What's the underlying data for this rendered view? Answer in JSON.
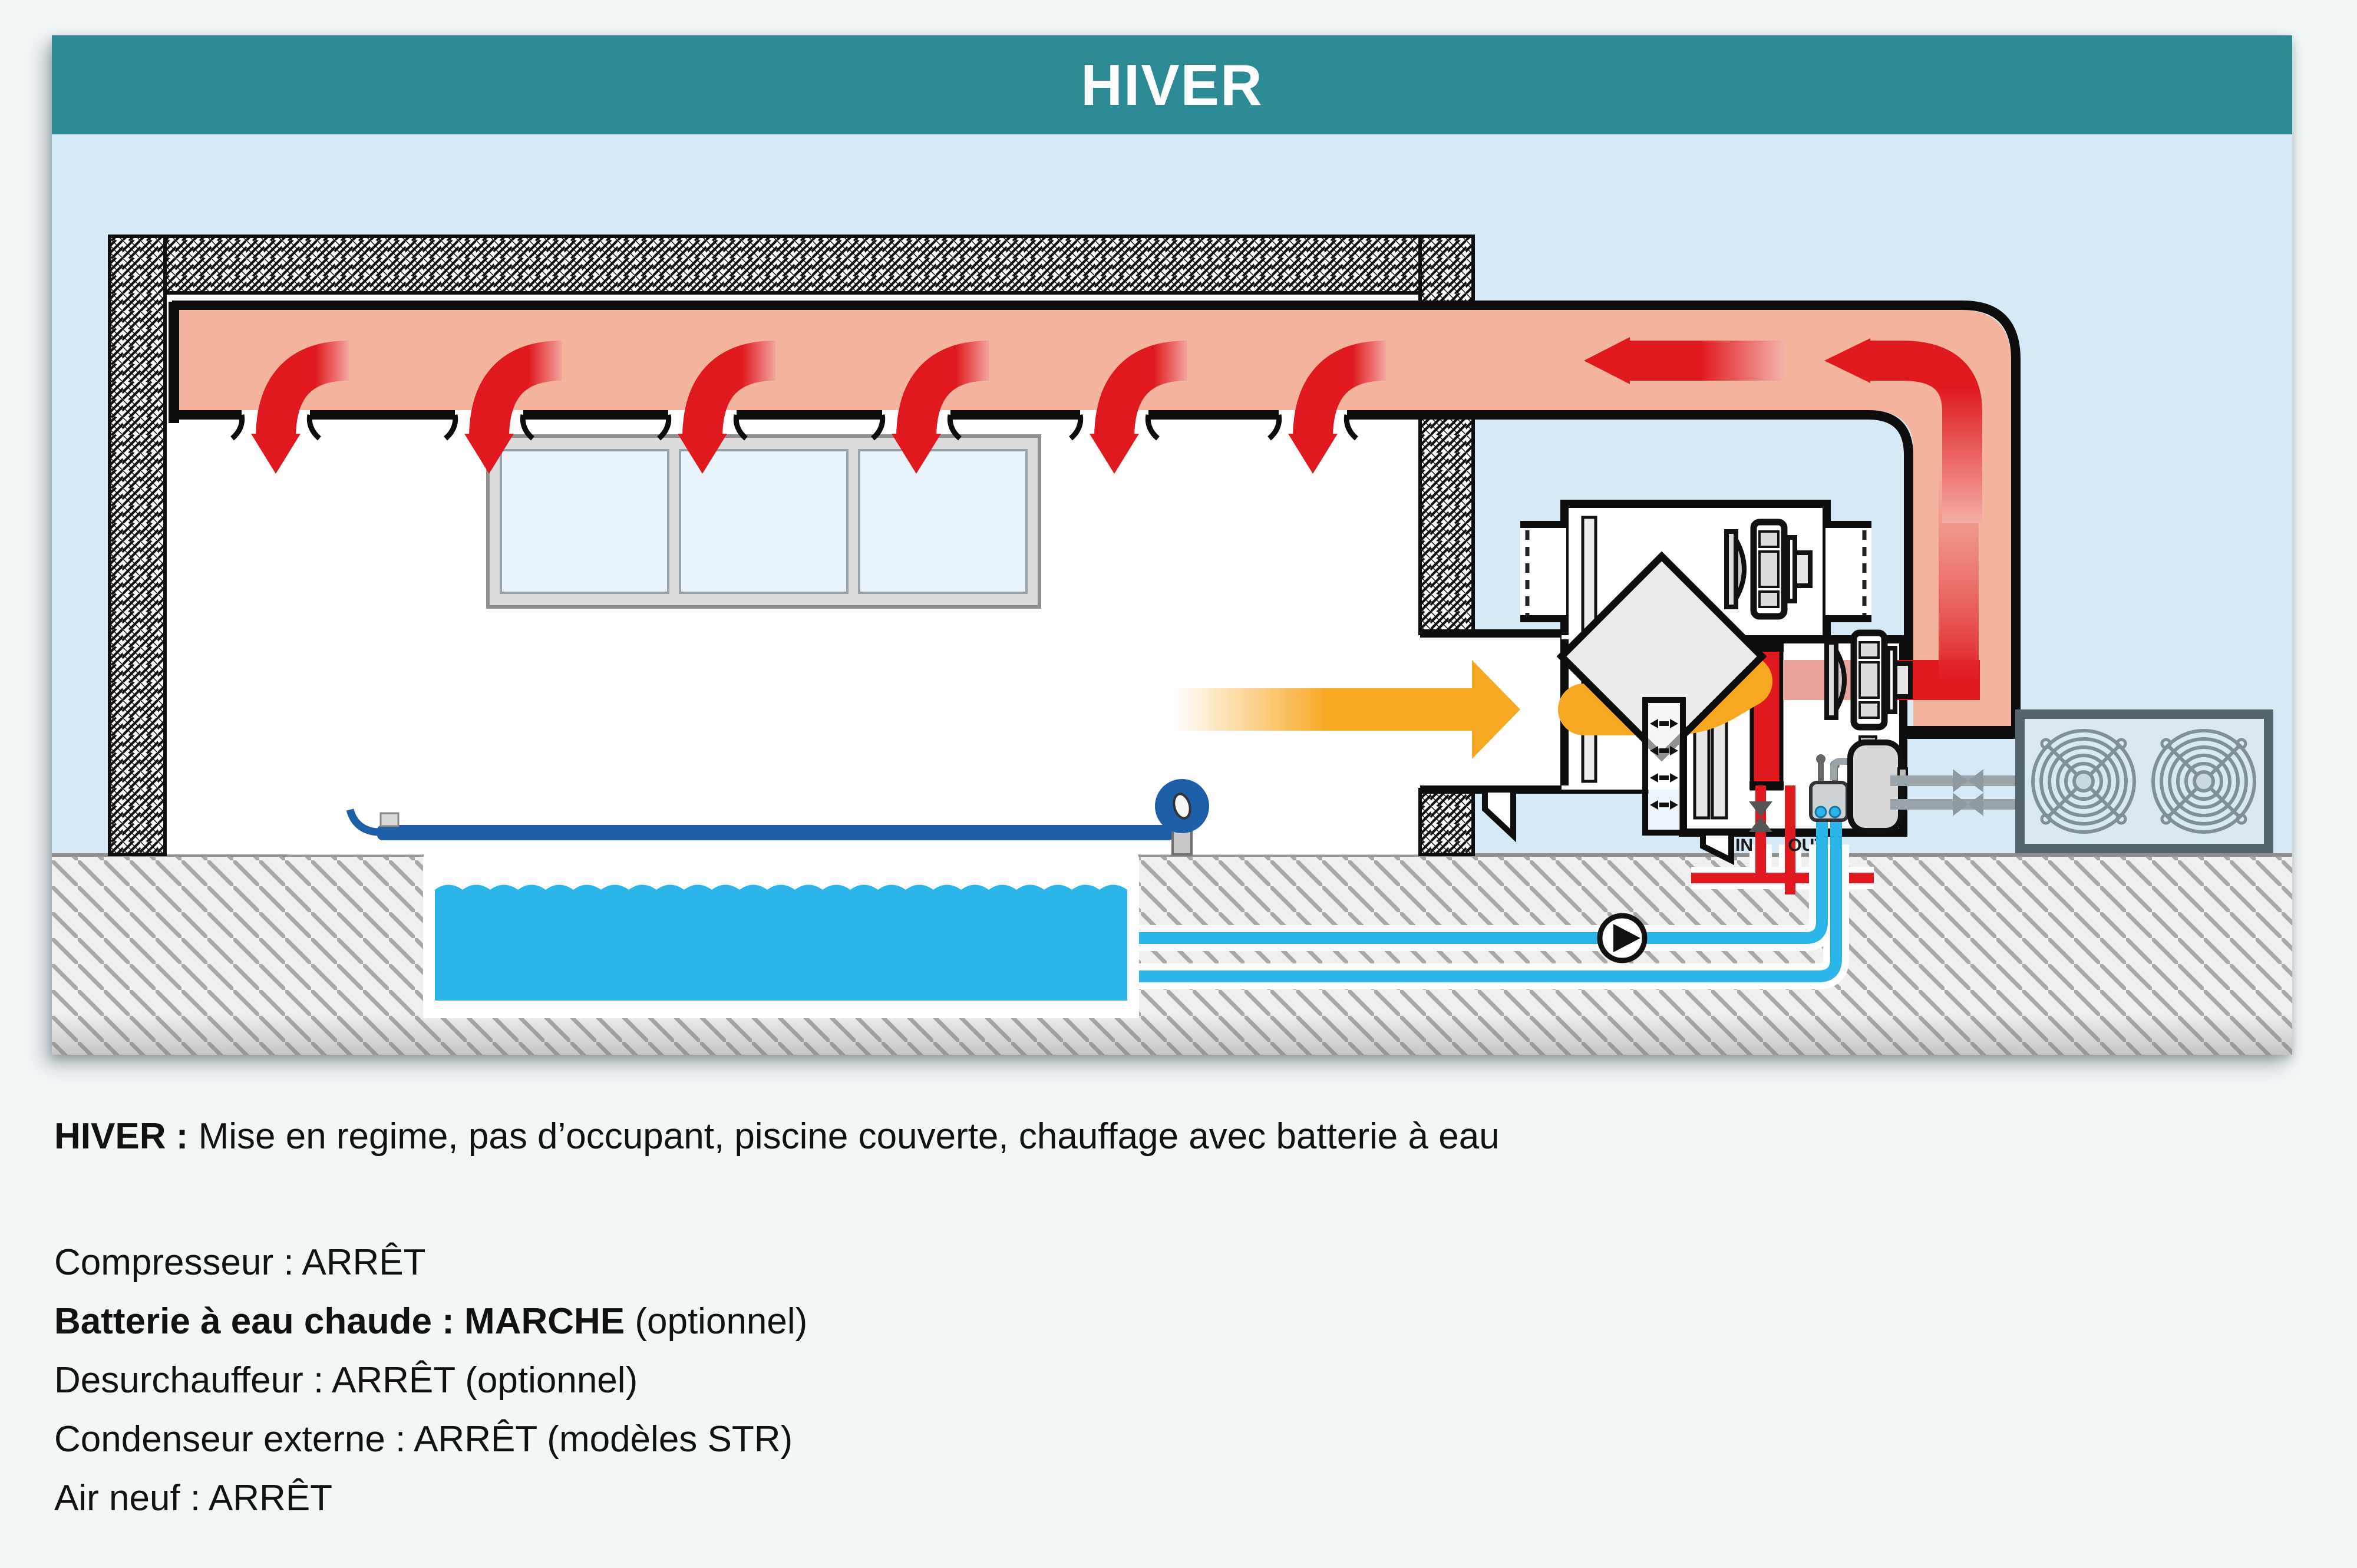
{
  "header": {
    "title": "HIVER"
  },
  "caption": {
    "strong": "HIVER :",
    "normal": " Mise en regime, pas d’occupant, piscine couverte, chauffage avec batterie à eau"
  },
  "status": {
    "lines": [
      {
        "strong": "",
        "normal": "Compresseur : ARRÊT"
      },
      {
        "strong": "Batterie à eau chaude : MARCHE",
        "normal": " (optionnel)"
      },
      {
        "strong": "",
        "normal": "Desurchauffeur : ARRÊT (optionnel)"
      },
      {
        "strong": "",
        "normal": "Condenseur externe : ARRÊT (modèles STR)"
      },
      {
        "strong": "",
        "normal": "Air neuf : ARRÊT"
      }
    ]
  },
  "diagram": {
    "labels": {
      "in": "IN",
      "out": "OUT"
    },
    "colors": {
      "header_bg": "#2b8a93",
      "panel_bg": "#d6e9f7",
      "duct_salmon": "#f4b49e",
      "hot_air_red": "#e0191f",
      "warm_air_orange": "#f7a823",
      "pool_water_cyan": "#2cb5e9",
      "pool_cover_blue": "#1e5fa9",
      "pipe_gray": "#9aa3a8",
      "condenser_frame": "#54656e",
      "ground_hatch": "#a9a9a9"
    }
  }
}
